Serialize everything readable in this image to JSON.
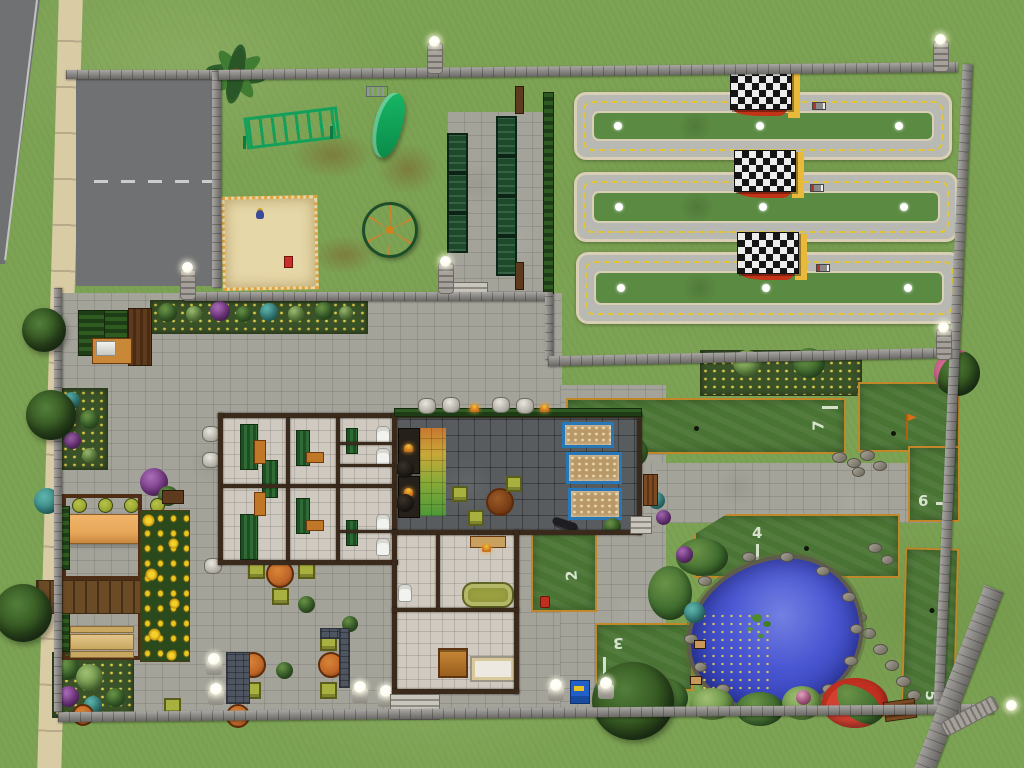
{
  "scene": {
    "view": "isometric community-lot overhead (life-sim game, no HUD visible)"
  },
  "minigolf": {
    "holes": [
      {
        "id": "hole-7",
        "number": "7"
      },
      {
        "id": "hole-6",
        "number": "6"
      },
      {
        "id": "hole-4",
        "number": "4"
      },
      {
        "id": "hole-2",
        "number": "2"
      },
      {
        "id": "hole-3",
        "number": "3"
      },
      {
        "id": "hole-5",
        "number": "5"
      }
    ]
  },
  "counts": {
    "race_tracks": 3,
    "park_benches": 7,
    "bar_stools": 4,
    "checkered_flags": 3
  },
  "colors": {
    "grass": "#7CA253",
    "road": "#6F7173",
    "sidewalk": "#D9CBA4",
    "pavement": "#A3A39A",
    "wallStone": "#8C8984",
    "buildingWall": "#3A2A1C",
    "floorTile": "#CFC9BF",
    "darkTile": "#585C5E",
    "trackRoad": "#B8B9B3",
    "trackBorder": "#D8CFB4",
    "trackLine": "#E2C436",
    "infield": "#5B8A42",
    "golfGreen": "#4A7434",
    "golfBorder": "#C08828",
    "golfNumber": "#E4ECDC",
    "pond": "#3744BC",
    "playEquip": "#12A35C",
    "benchGreen": "#1C4A2A",
    "tableClay": "#C06828",
    "chairGreen": "#A8B040",
    "stoolGreen": "#9AA832",
    "canopy": "#E8A85C",
    "sand": "#E6D7A8",
    "deck": "#6B4A26",
    "flagYellow": "#E8B93A",
    "flagRed": "#C23318",
    "aquariumBlue": "#2878B8",
    "tubOlive": "#9AA040",
    "sunflower": "#E8C820",
    "lampGlow": "#FFFDF0",
    "binBlue": "#2060C8"
  }
}
